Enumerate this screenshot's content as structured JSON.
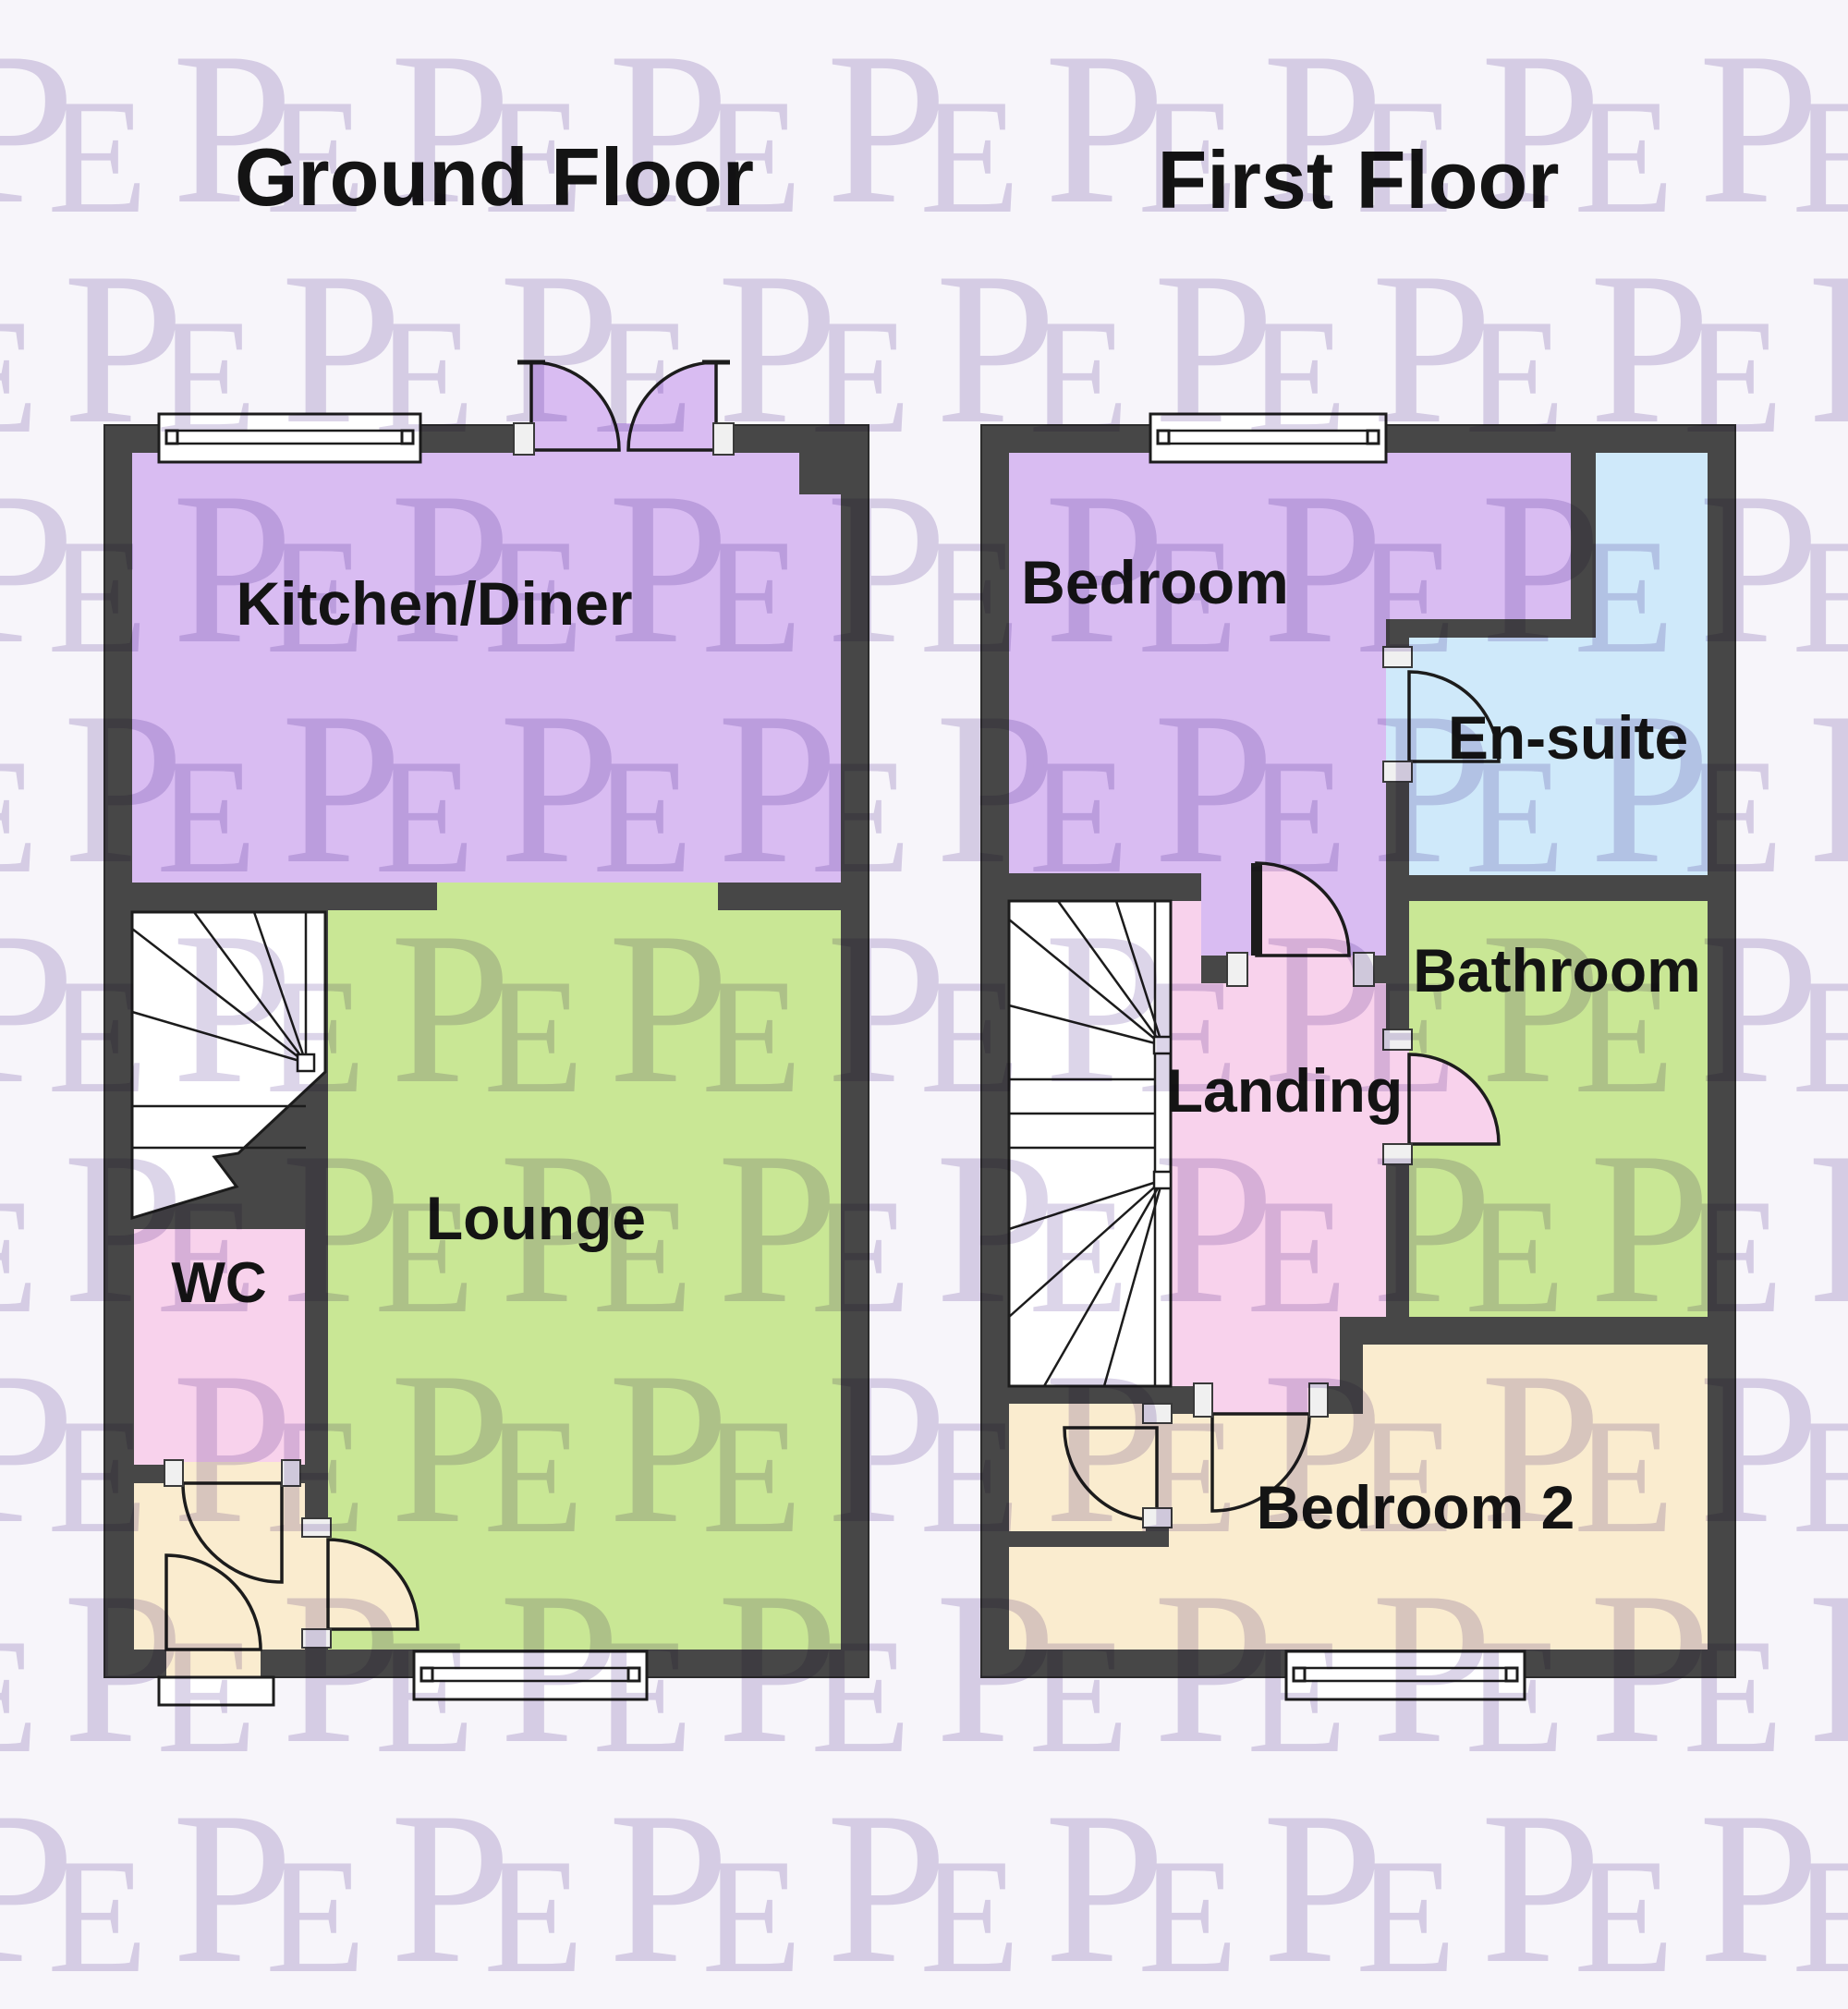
{
  "watermark": {
    "text_p": "P",
    "text_e": "E"
  },
  "colors": {
    "background": "#f7f5fa",
    "watermark": "#dcd5e9",
    "wall": "#474747",
    "line": "#1c1c1c",
    "jamb": "#f0f0f0",
    "text": "#141414",
    "purple": "#d9bcf2",
    "green": "#c9e795",
    "pink": "#f8d2ec",
    "beige": "#faeccf",
    "blue": "#cfe9fa"
  },
  "ground_floor": {
    "title": "Ground Floor",
    "rooms": [
      {
        "label": "Kitchen/Diner"
      },
      {
        "label": "Lounge"
      },
      {
        "label": "WC"
      }
    ]
  },
  "first_floor": {
    "title": "First Floor",
    "rooms": [
      {
        "label": "Bedroom"
      },
      {
        "label": "En-suite"
      },
      {
        "label": "Bathroom"
      },
      {
        "label": "Landing"
      },
      {
        "label": "Bedroom 2"
      }
    ]
  }
}
